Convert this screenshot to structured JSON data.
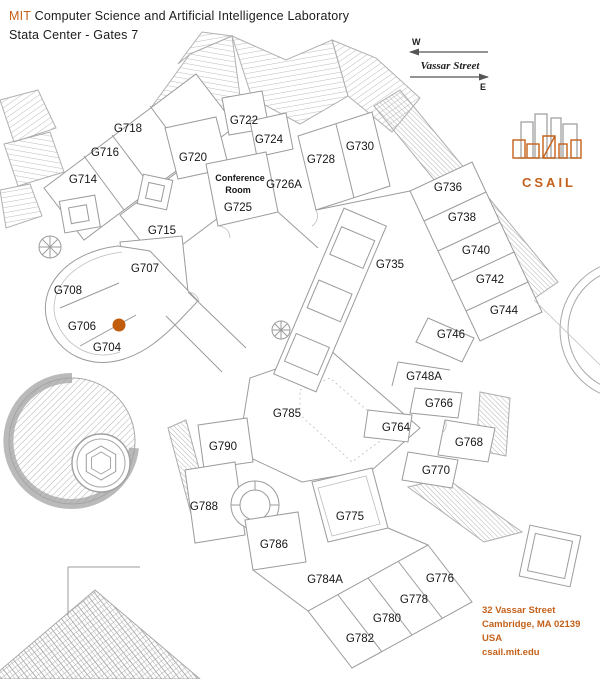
{
  "header": {
    "brand": "MIT",
    "title": "Computer Science and Artificial Intelligence Laboratory",
    "subtitle": "Stata Center - Gates 7"
  },
  "compass": {
    "west": "W",
    "east": "E",
    "street": "Vassar Street"
  },
  "logo": {
    "text": "CSAIL"
  },
  "address": {
    "lines": [
      "32 Vassar Street",
      "Cambridge, MA 02139",
      "USA",
      "csail.mit.edu"
    ]
  },
  "map": {
    "floor": "Gates 7",
    "marker": {
      "room": "G704",
      "color": "#c05e0e"
    },
    "conference": {
      "line1": "Conference",
      "line2": "Room"
    },
    "rooms": [
      "G718",
      "G716",
      "G714",
      "G722",
      "G724",
      "G720",
      "G728",
      "G730",
      "G726A",
      "G725",
      "G715",
      "G736",
      "G738",
      "G740",
      "G707",
      "G735",
      "G742",
      "G708",
      "G744",
      "G706",
      "G704",
      "G746",
      "G748A",
      "G766",
      "G785",
      "G764",
      "G790",
      "G768",
      "G770",
      "G788",
      "G775",
      "G786",
      "G784A",
      "G776",
      "G778",
      "G780",
      "G782"
    ]
  },
  "colors": {
    "accent": "#c4611a",
    "marker": "#c05e0e",
    "plan_line": "#9b9b9b"
  }
}
